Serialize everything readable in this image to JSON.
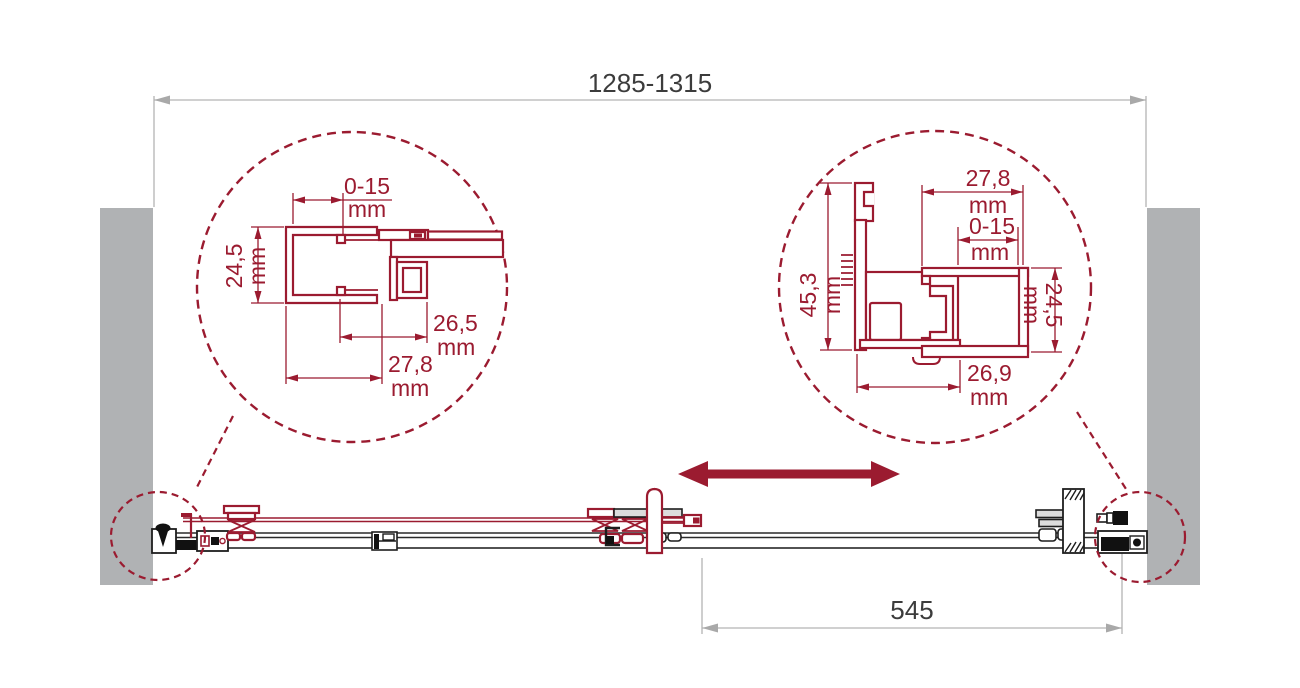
{
  "colors": {
    "accent_maroon": "#9b1b30",
    "wall_gray": "#b0b2b4",
    "dimension_gray": "#b3b3b3",
    "text_dark": "#3c3c3c",
    "hardware_black": "#1d1d1d"
  },
  "overall_width": {
    "value": "1285-1315"
  },
  "travel": {
    "value": "545"
  },
  "left_detail": {
    "adjust": {
      "v": "0-15",
      "u": "mm"
    },
    "height": {
      "v": "24,5",
      "u": "mm"
    },
    "inner": {
      "v": "26,5",
      "u": "mm"
    },
    "outer": {
      "v": "27,8",
      "u": "mm"
    }
  },
  "right_detail": {
    "width": {
      "v": "27,8",
      "u": "mm"
    },
    "adjust": {
      "v": "0-15",
      "u": "mm"
    },
    "height": {
      "v": "45,3",
      "u": "mm"
    },
    "side": {
      "v": "24,5",
      "u": "mm"
    },
    "bottom": {
      "v": "26,9",
      "u": "mm"
    }
  }
}
